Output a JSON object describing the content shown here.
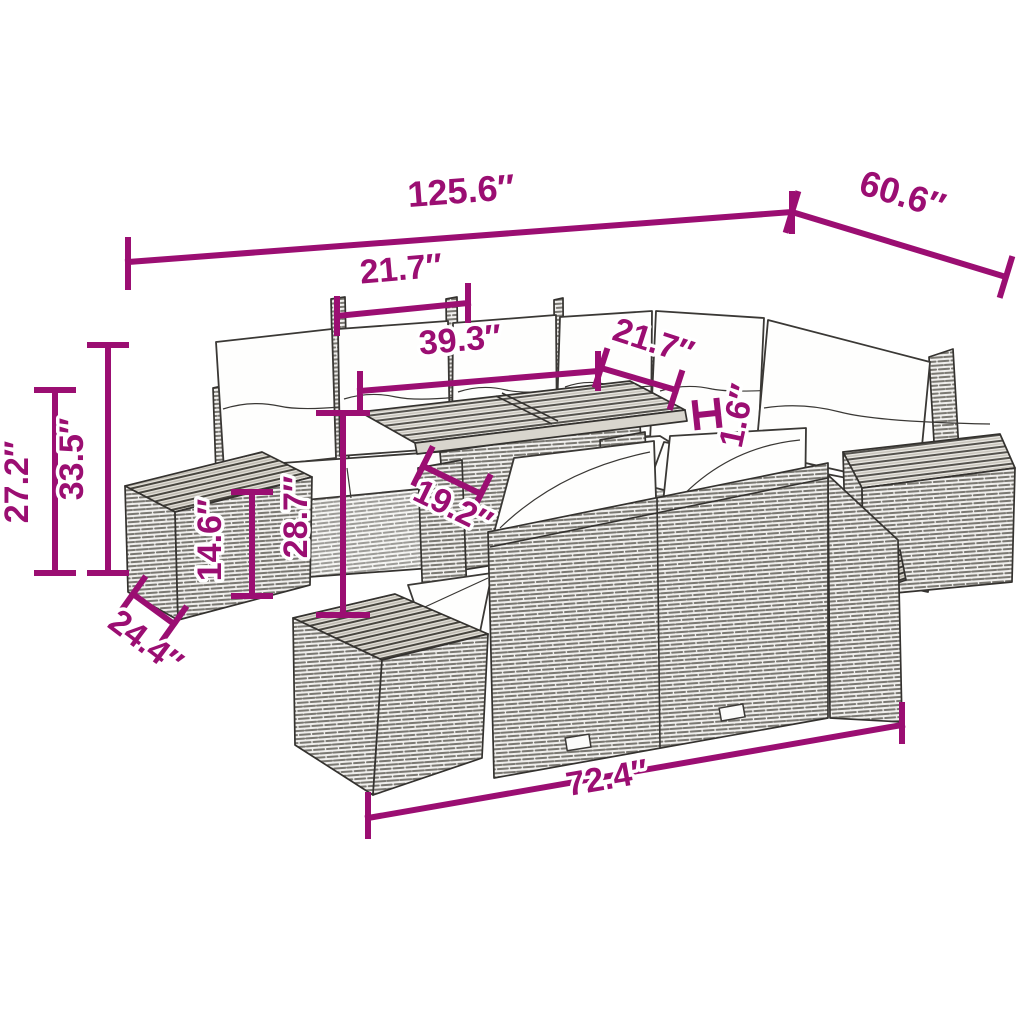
{
  "title": "Garden furniture set dimension diagram",
  "colors": {
    "dimension_accent": "#9b0e72",
    "line_art": "#34322f",
    "cushion": "#ffffff",
    "background": "#ffffff"
  },
  "measurements": [
    {
      "id": "overall-width",
      "value": "125.6″",
      "location": "top span across whole set"
    },
    {
      "id": "overall-depth",
      "value": "60.6″",
      "location": "top right diagonal"
    },
    {
      "id": "back-module-width",
      "value": "21.7″",
      "location": "upper middle, one back seat module"
    },
    {
      "id": "table-length",
      "value": "39.3″",
      "location": "above table top"
    },
    {
      "id": "right-module-width",
      "value": "21.7″",
      "location": "right diagonal module width"
    },
    {
      "id": "tabletop-thickness",
      "value": "1.6″",
      "location": "right of table edge, rotated"
    },
    {
      "id": "height-outer-left",
      "value": "27.2″",
      "location": "far left vertical"
    },
    {
      "id": "height-inner-left",
      "value": "33.5″",
      "location": "left vertical"
    },
    {
      "id": "side-table-height",
      "value": "14.6″",
      "location": "on left side table, rotated"
    },
    {
      "id": "bench-height",
      "value": "28.7″",
      "location": "center vertical, rotated"
    },
    {
      "id": "table-depth",
      "value": "19.2″",
      "location": "diagonal at table base"
    },
    {
      "id": "module-depth",
      "value": "24.4″",
      "location": "bottom left diagonal"
    },
    {
      "id": "bench-length",
      "value": "72.4″",
      "location": "bottom span under front bench"
    }
  ]
}
